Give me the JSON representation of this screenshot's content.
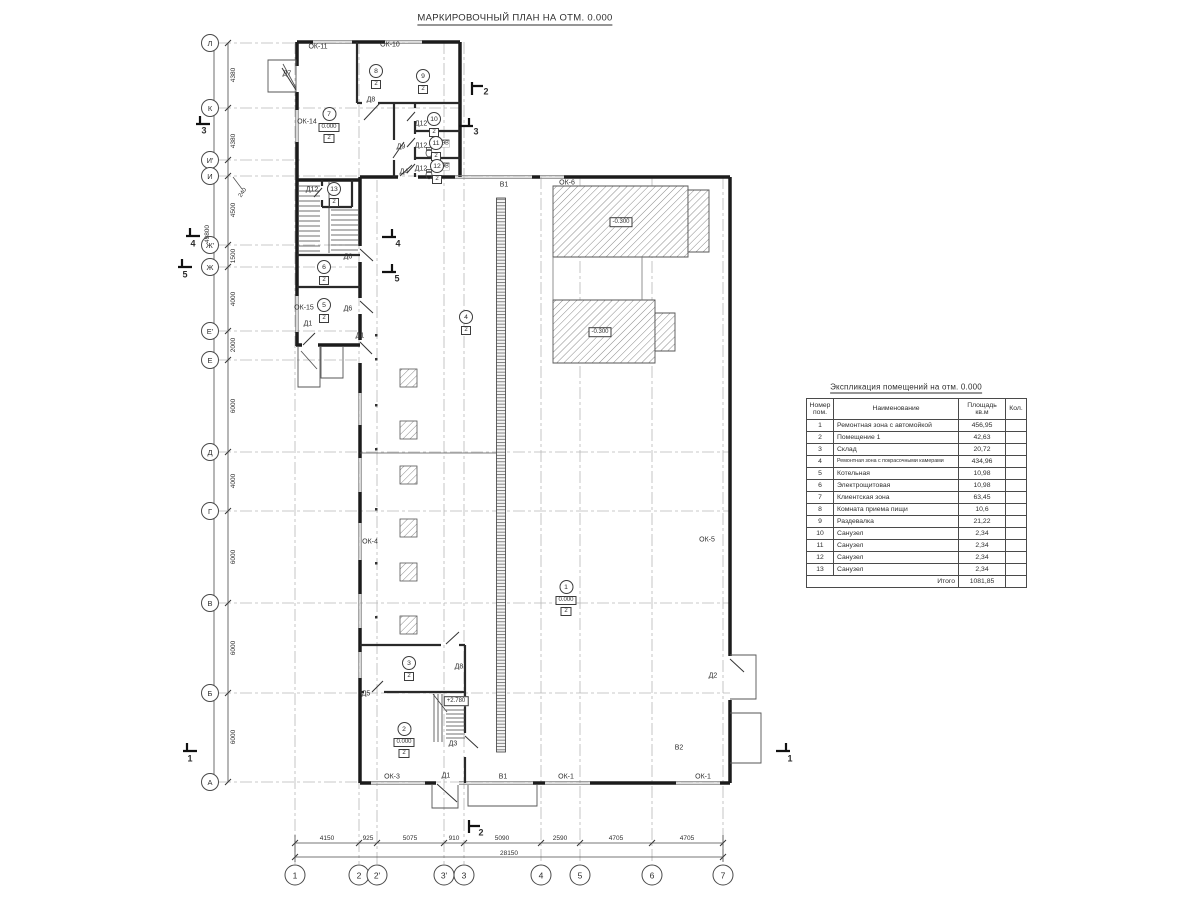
{
  "title": "МАРКИРОВОЧНЫЙ ПЛАН НА ОТМ. 0.000",
  "table": {
    "title": "Экспликация помещений на отм. 0.000",
    "headers": {
      "num": "Номер\nпом.",
      "name": "Наименование",
      "area": "Площадь\nкв.м",
      "qty": "Кол."
    },
    "rows": [
      {
        "num": "1",
        "name": "Ремонтная зона с автомойкой",
        "area": "456,95"
      },
      {
        "num": "2",
        "name": "Помещение 1",
        "area": "42,63"
      },
      {
        "num": "3",
        "name": "Склад",
        "area": "20,72"
      },
      {
        "num": "4",
        "name": "Ремонтная зона с покрасочными камерами",
        "area": "434,96"
      },
      {
        "num": "5",
        "name": "Котельная",
        "area": "10,98"
      },
      {
        "num": "6",
        "name": "Электрощитовая",
        "area": "10,98"
      },
      {
        "num": "7",
        "name": "Клиентская зона",
        "area": "63,45"
      },
      {
        "num": "8",
        "name": "Комната приема пищи",
        "area": "10,6"
      },
      {
        "num": "9",
        "name": "Раздевалка",
        "area": "21,22"
      },
      {
        "num": "10",
        "name": "Санузел",
        "area": "2,34"
      },
      {
        "num": "11",
        "name": "Санузел",
        "area": "2,34"
      },
      {
        "num": "12",
        "name": "Санузел",
        "area": "2,34"
      },
      {
        "num": "13",
        "name": "Санузел",
        "area": "2,34"
      }
    ],
    "total_label": "Итого",
    "total_value": "1081,85"
  },
  "grid": {
    "rows": [
      {
        "label": "Л",
        "y": 43,
        "x2": 460
      },
      {
        "label": "К",
        "y": 108,
        "x2": 460
      },
      {
        "label": "И'",
        "y": 160,
        "x2": 300
      },
      {
        "label": "И",
        "y": 176,
        "x2": 730
      },
      {
        "label": "Ж'",
        "y": 245,
        "x2": 360
      },
      {
        "label": "Ж",
        "y": 267,
        "x2": 360
      },
      {
        "label": "Е'",
        "y": 331,
        "x2": 360
      },
      {
        "label": "Е",
        "y": 360,
        "x2": 360
      },
      {
        "label": "Д",
        "y": 452,
        "x2": 730
      },
      {
        "label": "Г",
        "y": 511,
        "x2": 730
      },
      {
        "label": "В",
        "y": 603,
        "x2": 730
      },
      {
        "label": "Б",
        "y": 693,
        "x2": 730
      },
      {
        "label": "А",
        "y": 782,
        "x2": 730
      }
    ],
    "cols": [
      {
        "label": "1",
        "x": 295,
        "y1": 42
      },
      {
        "label": "2",
        "x": 359,
        "y1": 42
      },
      {
        "label": "2'",
        "x": 377,
        "y1": 180
      },
      {
        "label": "3'",
        "x": 444,
        "y1": 42
      },
      {
        "label": "3",
        "x": 464,
        "y1": 42
      },
      {
        "label": "4",
        "x": 541,
        "y1": 177
      },
      {
        "label": "5",
        "x": 580,
        "y1": 177
      },
      {
        "label": "6",
        "x": 652,
        "y1": 177
      },
      {
        "label": "7",
        "x": 723,
        "y1": 177
      }
    ],
    "v_dims": [
      {
        "text": "4380",
        "y": 75
      },
      {
        "text": "4380",
        "y": 141
      },
      {
        "text": "4500",
        "y": 210
      },
      {
        "text": "1500",
        "y": 256
      },
      {
        "text": "4000",
        "y": 299
      },
      {
        "text": "2000",
        "y": 345
      },
      {
        "text": "6000",
        "y": 406
      },
      {
        "text": "4000",
        "y": 481
      },
      {
        "text": "6000",
        "y": 557
      },
      {
        "text": "6000",
        "y": 648
      },
      {
        "text": "6000",
        "y": 737
      }
    ],
    "h_dims": [
      {
        "text": "4150",
        "x": 327
      },
      {
        "text": "925",
        "x": 368
      },
      {
        "text": "5075",
        "x": 410
      },
      {
        "text": "910",
        "x": 454
      },
      {
        "text": "5090",
        "x": 502
      },
      {
        "text": "2590",
        "x": 560
      },
      {
        "text": "4705",
        "x": 616
      },
      {
        "text": "4705",
        "x": 687
      }
    ],
    "offset_dim": {
      "text": "240",
      "x": 243,
      "y": 193
    },
    "total_v": {
      "text": "49800",
      "x": 208,
      "y": 234
    },
    "total_h": {
      "text": "28150",
      "x": 509,
      "y": 854
    }
  },
  "sections": [
    {
      "label": "3",
      "x": 204,
      "y": 131
    },
    {
      "label": "3",
      "x": 476,
      "y": 132
    },
    {
      "label": "4",
      "x": 193,
      "y": 244
    },
    {
      "label": "4",
      "x": 398,
      "y": 244
    },
    {
      "label": "5",
      "x": 185,
      "y": 275
    },
    {
      "label": "5",
      "x": 397,
      "y": 279
    },
    {
      "label": "1",
      "x": 190,
      "y": 759
    },
    {
      "label": "1",
      "x": 790,
      "y": 759
    },
    {
      "label": "2",
      "x": 486,
      "y": 92
    },
    {
      "label": "2",
      "x": 481,
      "y": 833
    }
  ],
  "plan": {
    "annotations": [
      {
        "kind": "door",
        "text": "Д7",
        "x": 287,
        "y": 74
      },
      {
        "kind": "door",
        "text": "Д8",
        "x": 371,
        "y": 100
      },
      {
        "kind": "door",
        "text": "Д9",
        "x": 401,
        "y": 147
      },
      {
        "kind": "door",
        "text": "Д4",
        "x": 404,
        "y": 172
      },
      {
        "kind": "door",
        "text": "Д12",
        "x": 421,
        "y": 124
      },
      {
        "kind": "door",
        "text": "Д12",
        "x": 421,
        "y": 146
      },
      {
        "kind": "door",
        "text": "Д12",
        "x": 421,
        "y": 169
      },
      {
        "kind": "door",
        "text": "Д12",
        "x": 312,
        "y": 190
      },
      {
        "kind": "door",
        "text": "Д6",
        "x": 348,
        "y": 257
      },
      {
        "kind": "door",
        "text": "Д6",
        "x": 348,
        "y": 309
      },
      {
        "kind": "door",
        "text": "Д1",
        "x": 308,
        "y": 324
      },
      {
        "kind": "door",
        "text": "Д1",
        "x": 360,
        "y": 336
      },
      {
        "kind": "door",
        "text": "Д5",
        "x": 366,
        "y": 694
      },
      {
        "kind": "door",
        "text": "Д8",
        "x": 459,
        "y": 667
      },
      {
        "kind": "door",
        "text": "Д3",
        "x": 453,
        "y": 744
      },
      {
        "kind": "door",
        "text": "Д1",
        "x": 446,
        "y": 776
      },
      {
        "kind": "door",
        "text": "Д2",
        "x": 713,
        "y": 676
      },
      {
        "kind": "window",
        "text": "ОК-11",
        "x": 318,
        "y": 47
      },
      {
        "kind": "window",
        "text": "ОК-10",
        "x": 390,
        "y": 45
      },
      {
        "kind": "window",
        "text": "ОК-14",
        "x": 307,
        "y": 122
      },
      {
        "kind": "window",
        "text": "ОК-15",
        "x": 304,
        "y": 308
      },
      {
        "kind": "window",
        "text": "ОК-4",
        "x": 370,
        "y": 542
      },
      {
        "kind": "window",
        "text": "ОК-5",
        "x": 707,
        "y": 540
      },
      {
        "kind": "window",
        "text": "ОК-6",
        "x": 567,
        "y": 183
      },
      {
        "kind": "window",
        "text": "ОК-3",
        "x": 392,
        "y": 777
      },
      {
        "kind": "window",
        "text": "ОК-1",
        "x": 566,
        "y": 777
      },
      {
        "kind": "window",
        "text": "ОК-1",
        "x": 703,
        "y": 777
      },
      {
        "kind": "gate",
        "text": "В1",
        "x": 504,
        "y": 185
      },
      {
        "kind": "gate",
        "text": "В1",
        "x": 503,
        "y": 777
      },
      {
        "kind": "gate",
        "text": "В2",
        "x": 679,
        "y": 748
      },
      {
        "kind": "equipment",
        "text": "ЭВ",
        "x": 445,
        "y": 144
      },
      {
        "kind": "equipment",
        "text": "ЭВ",
        "x": 445,
        "y": 167
      }
    ],
    "rooms": [
      {
        "num": "1",
        "x": 566,
        "y": 580,
        "elev": "0.000",
        "type": "2"
      },
      {
        "num": "2",
        "x": 404,
        "y": 722,
        "elev": "0.000",
        "type": "2"
      },
      {
        "num": "3",
        "x": 409,
        "y": 656,
        "type": "2"
      },
      {
        "num": "4",
        "x": 466,
        "y": 310,
        "type": "2"
      },
      {
        "num": "5",
        "x": 324,
        "y": 298,
        "type": "2"
      },
      {
        "num": "6",
        "x": 324,
        "y": 260,
        "type": "2"
      },
      {
        "num": "7",
        "x": 329,
        "y": 107,
        "elev": "0.000",
        "type": "2"
      },
      {
        "num": "8",
        "x": 376,
        "y": 64,
        "type": "2"
      },
      {
        "num": "9",
        "x": 423,
        "y": 69,
        "type": "2"
      },
      {
        "num": "10",
        "x": 434,
        "y": 112,
        "type": "2"
      },
      {
        "num": "11",
        "x": 436,
        "y": 136,
        "type": "2"
      },
      {
        "num": "12",
        "x": 437,
        "y": 159,
        "type": "2"
      },
      {
        "num": "13",
        "x": 334,
        "y": 182,
        "type": "2"
      }
    ],
    "elevations": [
      {
        "text": "-0.300",
        "x": 621,
        "y": 222
      },
      {
        "text": "-0.300",
        "x": 600,
        "y": 332
      },
      {
        "text": "+2.780",
        "x": 456,
        "y": 701
      }
    ]
  }
}
